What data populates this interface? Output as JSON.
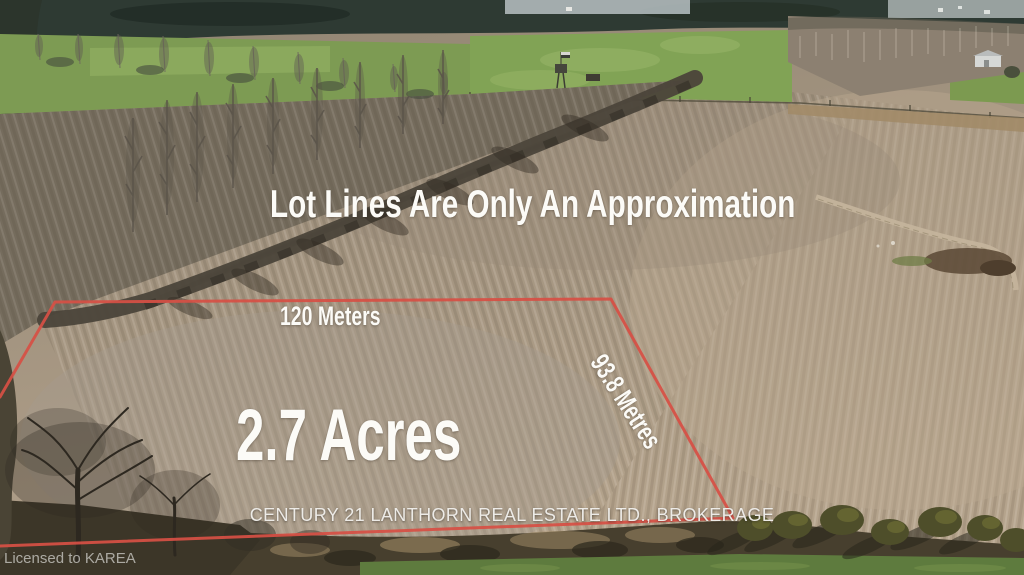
{
  "photo_overlay": {
    "disclaimer": "Lot Lines Are Only An Approximation",
    "frontage": {
      "label": "120 Meters",
      "value": 120,
      "unit": "meters"
    },
    "area": {
      "label": "2.7 Acres",
      "value": 2.7,
      "unit": "acres"
    },
    "depth": {
      "label": "93.8 Metres",
      "value": 93.8,
      "unit": "metres"
    },
    "brokerage": "CENTURY 21 LANTHORN REAL ESTATE LTD., BROKERAGE",
    "watermark": "Licensed to KAREA",
    "lot_boundary": {
      "color": "#d65045",
      "points": "0,397 55,302 611,299 733,518 0,546"
    }
  }
}
